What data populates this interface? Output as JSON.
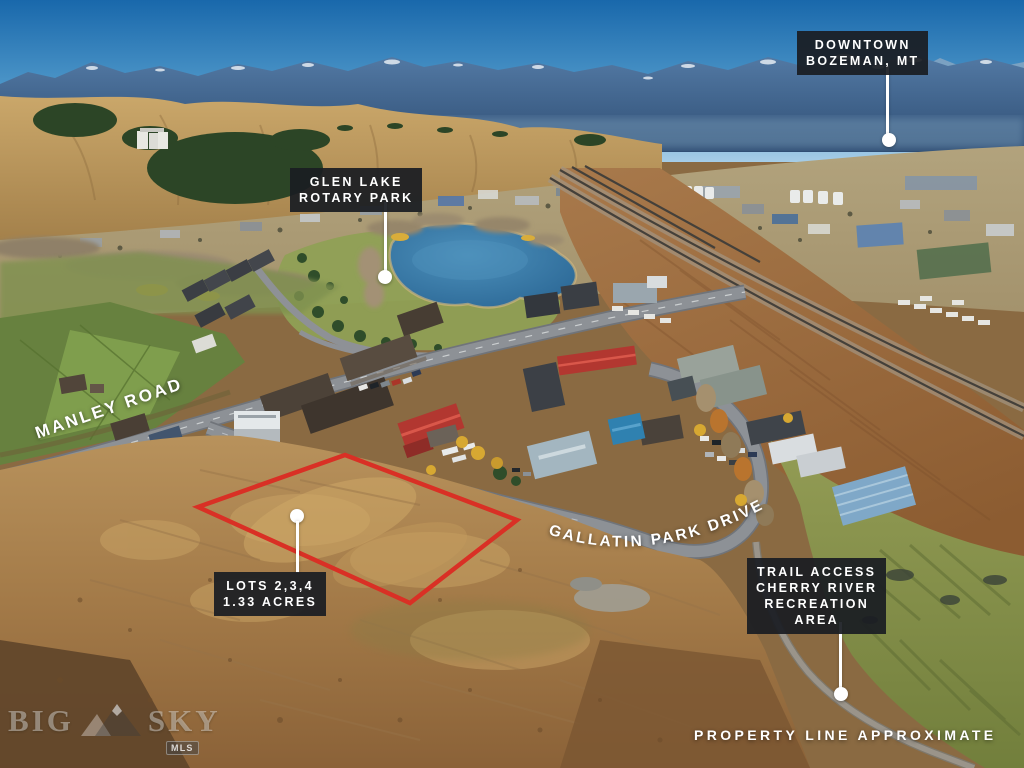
{
  "labels": {
    "downtown": {
      "lines": [
        "DOWNTOWN",
        "BOZEMAN, MT"
      ]
    },
    "glen_lake": {
      "lines": [
        "GLEN LAKE",
        "ROTARY PARK"
      ]
    },
    "lots": {
      "lines": [
        "LOTS 2,3,4",
        "1.33 ACRES"
      ]
    },
    "trail": {
      "lines": [
        "TRAIL ACCESS",
        "CHERRY RIVER",
        "RECREATION",
        "AREA"
      ]
    },
    "property_note": "PROPERTY LINE APPROXIMATE"
  },
  "road_names": {
    "manley": "MANLEY ROAD",
    "gallatin_park": "GALLATIN PARK DRIVE"
  },
  "watermark": {
    "word_left": "BIG",
    "word_right": "SKY",
    "badge": "MLS"
  },
  "colors": {
    "label_bg": "#1b1e22",
    "label_text": "#ffffff",
    "leader_line": "#ffffff",
    "lot_outline": "#d93025"
  }
}
